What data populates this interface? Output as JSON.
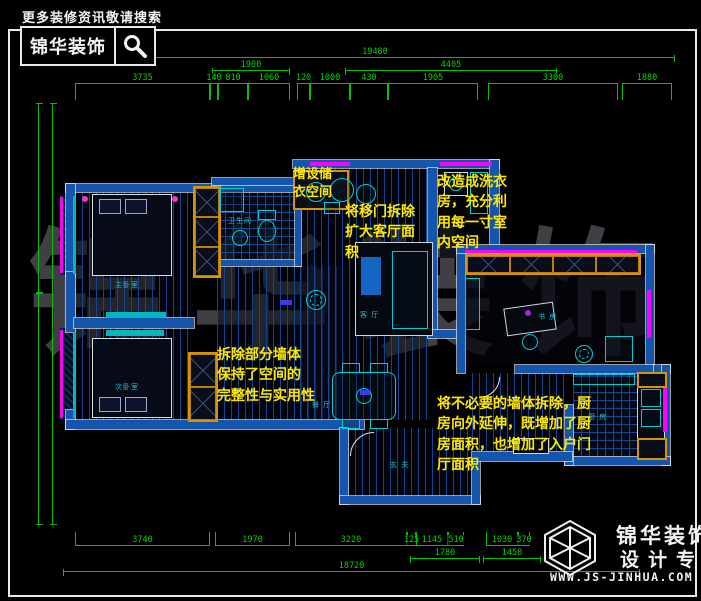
{
  "header": {
    "tagline": "更多装修资讯敬请搜索",
    "brand": "锦华装饰",
    "search_icon": "magnifier-icon"
  },
  "watermark": {
    "text": "锦华装饰"
  },
  "footer_logo": {
    "icon": "wireframe-cube-icon",
    "brand": "锦华装饰",
    "tagline": "设计专家",
    "website": "WWW.JS-JINHUA.COM"
  },
  "annotations": [
    {
      "id": "storage",
      "lines": [
        "增设储",
        "衣空间"
      ]
    },
    {
      "id": "sliding-door",
      "lines": [
        "将移门拆除",
        "扩大客厅面",
        "积"
      ]
    },
    {
      "id": "laundry",
      "lines": [
        "改造成洗衣",
        "房，充分利",
        "用每一寸室",
        "内空间"
      ]
    },
    {
      "id": "walls-removed",
      "lines": [
        "拆除部分墙体",
        "保持了空间的",
        "完整性与实用性"
      ]
    },
    {
      "id": "kitchen-extend",
      "lines": [
        "将不必要的墙体拆除，厨",
        "房向外延伸，既增加了厨",
        "房面积，也增加了入户门",
        "厅面积"
      ]
    }
  ],
  "room_labels": [
    {
      "name": "主卧室"
    },
    {
      "name": "次卧室"
    },
    {
      "name": "卫生间"
    },
    {
      "name": "客 厅"
    },
    {
      "name": "餐 厅"
    },
    {
      "name": "书 房"
    },
    {
      "name": "厨 房"
    },
    {
      "name": "玄 关"
    }
  ],
  "dimensions": {
    "top_total": {
      "dir": "h",
      "tick": "short",
      "items": [
        {
          "x": 75,
          "y": 57,
          "w": 600,
          "label": "19480"
        }
      ]
    },
    "top_level2": {
      "dir": "h",
      "tick": "short",
      "items": [
        {
          "x": 212,
          "y": 70,
          "w": 78,
          "label": "1900"
        },
        {
          "x": 345,
          "y": 70,
          "w": 212,
          "label": "4405"
        }
      ]
    },
    "top_level3": {
      "dir": "h",
      "tick": "down",
      "items": [
        {
          "x": 75,
          "y": 83,
          "w": 135,
          "label": "3735"
        },
        {
          "x": 210,
          "y": 83,
          "w": 8,
          "label": "140"
        },
        {
          "x": 218,
          "y": 83,
          "w": 30,
          "label": "810"
        },
        {
          "x": 248,
          "y": 83,
          "w": 42,
          "label": "1060"
        },
        {
          "x": 297,
          "y": 83,
          "w": 13,
          "label": "120"
        },
        {
          "x": 310,
          "y": 83,
          "w": 40,
          "label": "1000"
        },
        {
          "x": 350,
          "y": 83,
          "w": 38,
          "label": "430"
        },
        {
          "x": 388,
          "y": 83,
          "w": 90,
          "label": "1905"
        },
        {
          "x": 488,
          "y": 83,
          "w": 130,
          "label": "3300"
        },
        {
          "x": 622,
          "y": 83,
          "w": 50,
          "label": "1880"
        }
      ]
    },
    "bottom_level1": {
      "dir": "h",
      "tick": "up",
      "items": [
        {
          "x": 75,
          "y": 545,
          "w": 135,
          "label": "3740"
        },
        {
          "x": 215,
          "y": 545,
          "w": 75,
          "label": "1970"
        },
        {
          "x": 295,
          "y": 545,
          "w": 112,
          "label": "3220"
        },
        {
          "x": 407,
          "y": 545,
          "w": 9,
          "label": "125"
        },
        {
          "x": 416,
          "y": 545,
          "w": 32,
          "label": "1145"
        },
        {
          "x": 448,
          "y": 545,
          "w": 16,
          "label": "510"
        },
        {
          "x": 486,
          "y": 545,
          "w": 32,
          "label": "1030"
        },
        {
          "x": 518,
          "y": 545,
          "w": 12,
          "label": "370"
        }
      ]
    },
    "bottom_level2": {
      "dir": "h",
      "tick": "short",
      "items": [
        {
          "x": 410,
          "y": 558,
          "w": 70,
          "label": "1780"
        },
        {
          "x": 483,
          "y": 558,
          "w": 58,
          "label": "1450"
        }
      ]
    },
    "bottom_total": {
      "dir": "h",
      "tick": "short",
      "items": [
        {
          "x": 63,
          "y": 571,
          "w": 577,
          "label": "18720"
        }
      ]
    },
    "left_vertical": {
      "dir": "v",
      "tick": "short",
      "items": [
        {
          "x": 38,
          "y": 103,
          "h": 190,
          "label": ""
        },
        {
          "x": 38,
          "y": 293,
          "h": 232,
          "label": ""
        },
        {
          "x": 52,
          "y": 103,
          "h": 422,
          "label": ""
        }
      ]
    }
  },
  "colors": {
    "dimension_green": "#00c400",
    "wall_blue": "#1456ae",
    "window_magenta": "#ff00ff",
    "annotation_yellow": "#ffe800",
    "furniture_cyan": "#00cdd4",
    "cabinet_yellow": "#d89400"
  }
}
